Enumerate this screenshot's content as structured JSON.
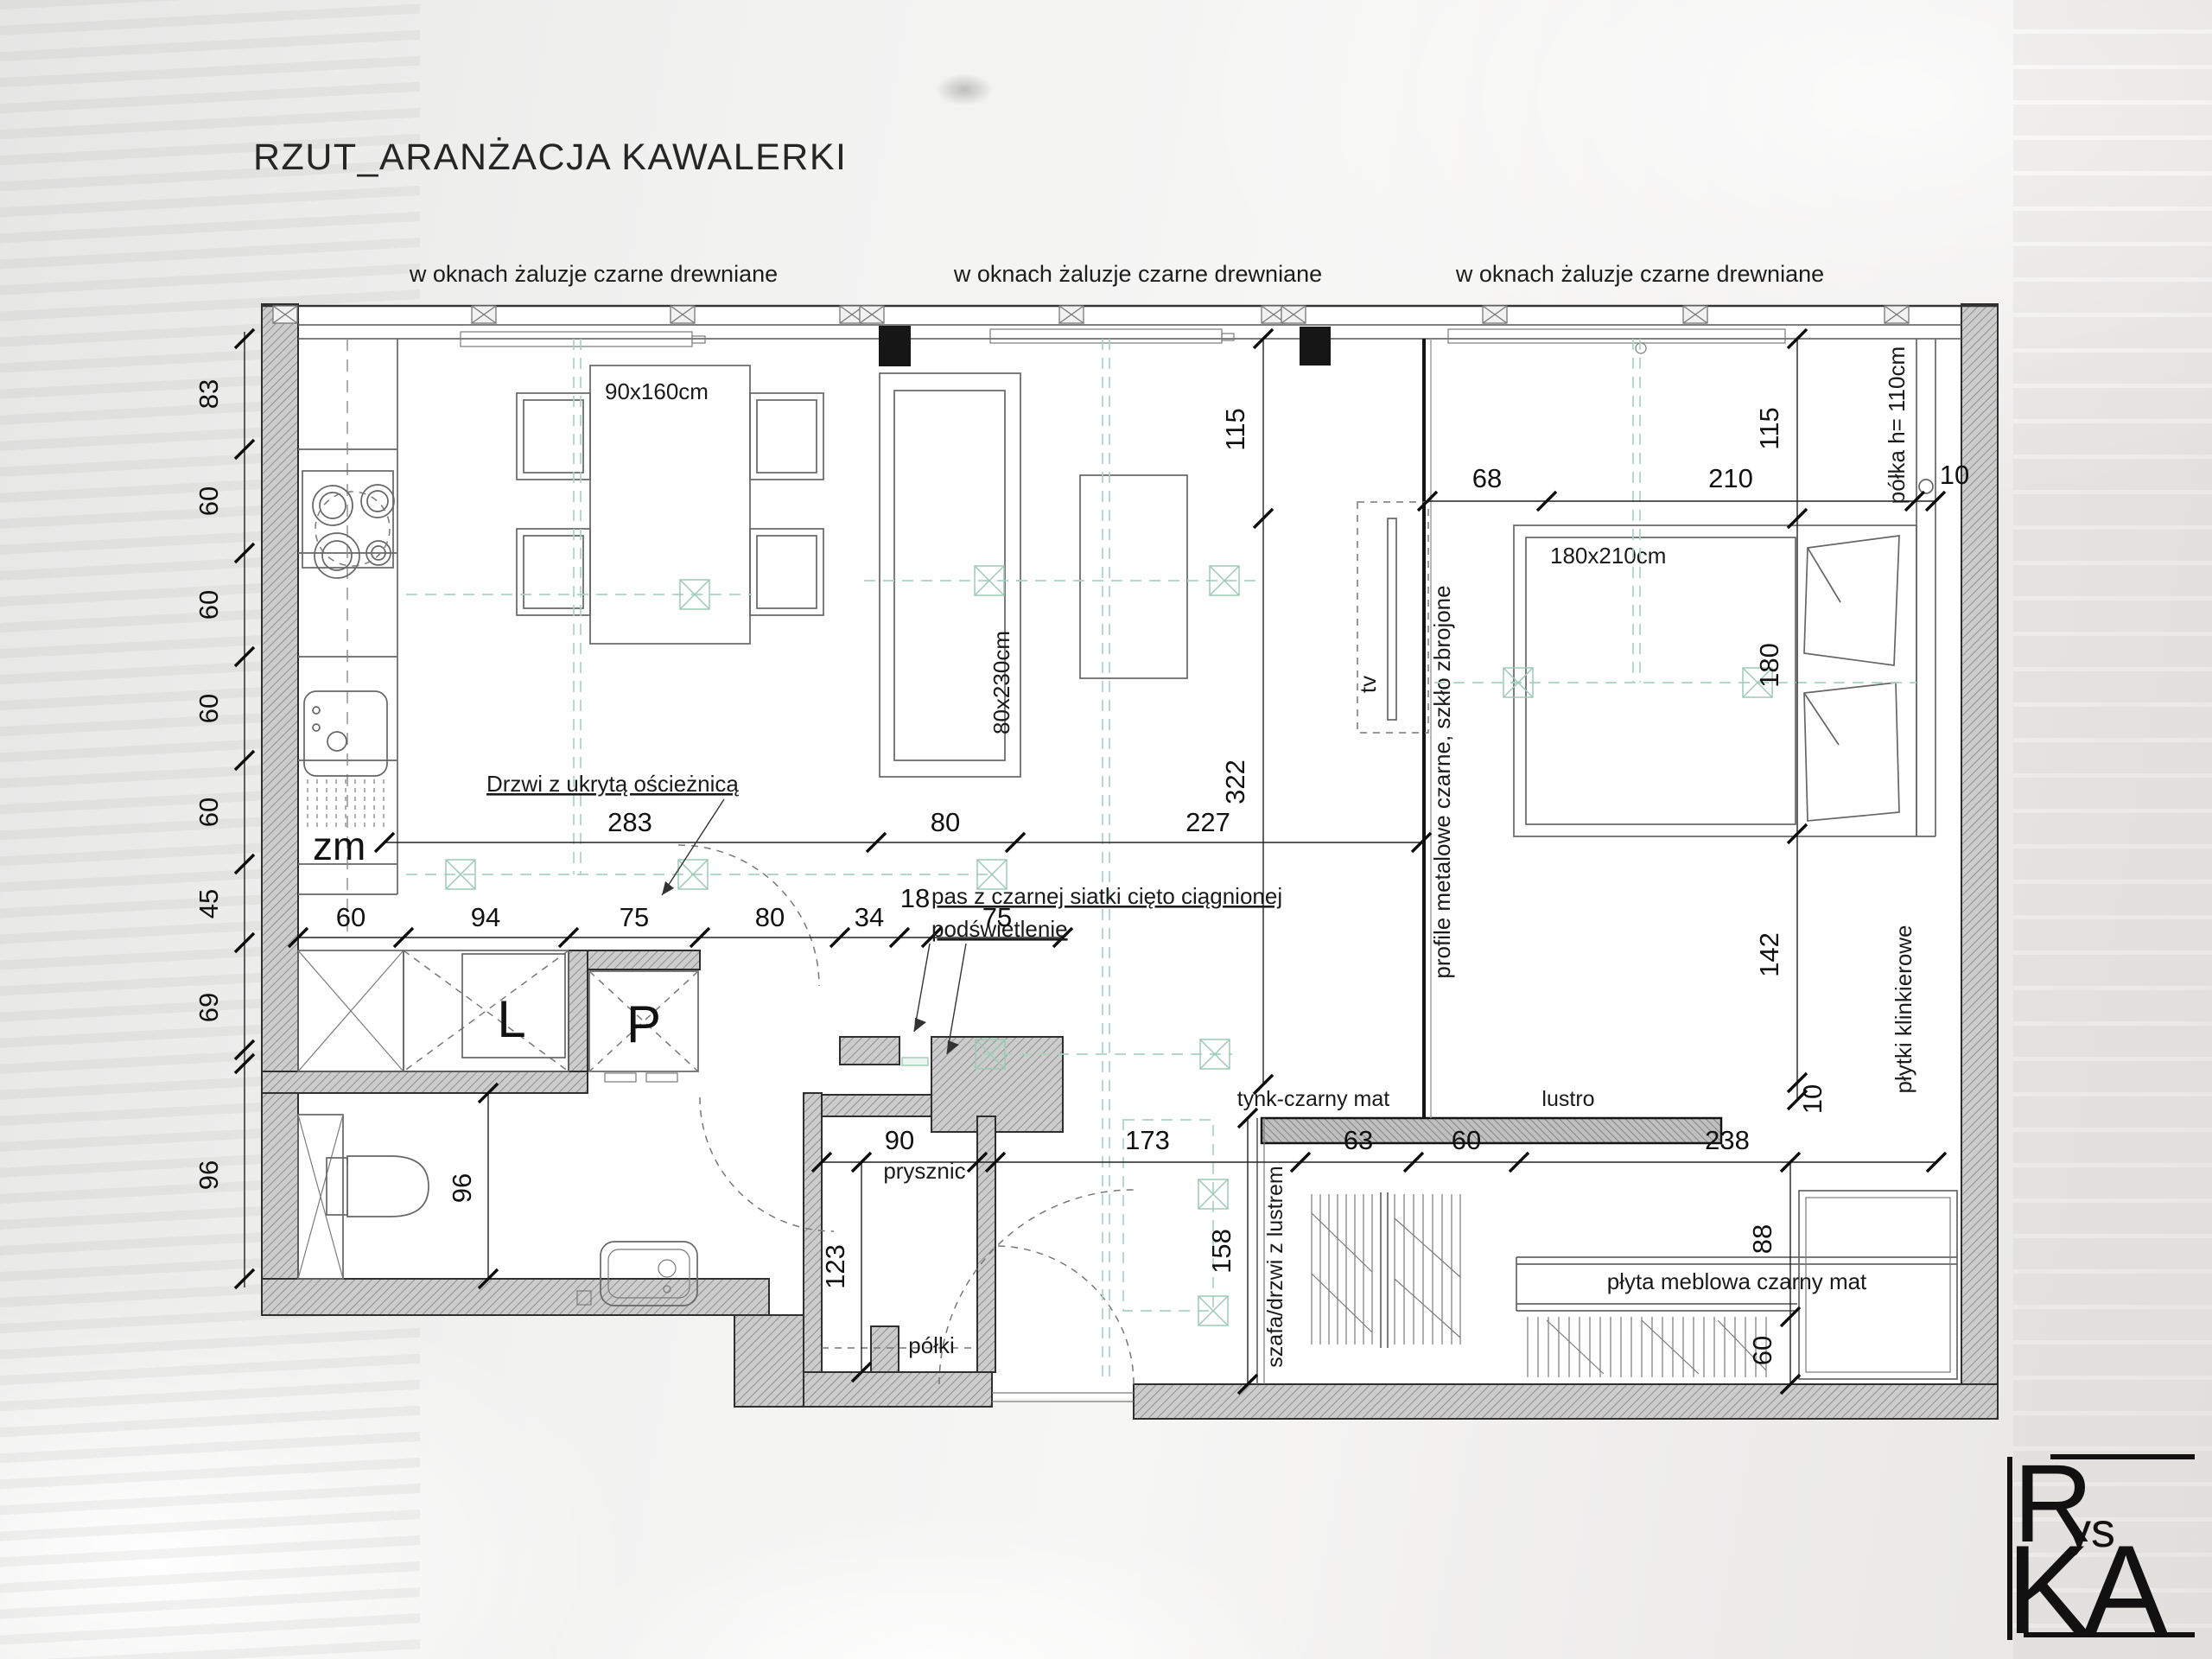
{
  "title": "RZUT_ARANŻACJA KAWALERKI",
  "window_notes": [
    "w oknach żaluzje czarne drewniane",
    "w oknach żaluzje czarne drewniane",
    "w oknach żaluzje czarne drewniane"
  ],
  "rooms": {
    "table_size": "90x160cm",
    "sofa_size": "80x230cm",
    "bed_size": "180x210cm",
    "sink_label": "zm",
    "cabinet_l": "L",
    "cabinet_p": "P",
    "tv": "tv",
    "shower": "prysznic",
    "shelves": "półki"
  },
  "notes": {
    "hidden_door": "Drzwi z ukrytą ościeżnicą",
    "mesh_line1": "pas z czarnej siatki cięto ciągnionej",
    "mesh_line2": "podświetlenie",
    "profiles": "profile metalowe czarne, szkło zbrojone",
    "shelf_height": "półka h= 110cm",
    "plaster": "tynk-czarny mat",
    "mirror": "lustro",
    "wardrobe": "szafa/drzwi z lustrem",
    "board": "płyta meblowa czarny mat",
    "clinker": "płytki klinkierowe"
  },
  "dims": {
    "left_chain": [
      "83",
      "60",
      "60",
      "60",
      "60",
      "45",
      "69",
      "96"
    ],
    "left_inner": [
      "115",
      "322"
    ],
    "mid_row": [
      "283",
      "80",
      "227"
    ],
    "cabinet_row": [
      "60",
      "94",
      "75",
      "80",
      "34",
      "18",
      "75"
    ],
    "bath": "96",
    "shower_w": "90",
    "shower_l": "123",
    "bottom_row": [
      "173",
      "63",
      "60",
      "238"
    ],
    "hall": "158",
    "desk": [
      "88",
      "60"
    ],
    "bed_top": [
      "68",
      "210"
    ],
    "shelf_gap": "10",
    "right_chain": [
      "115",
      "180",
      "142"
    ],
    "right_gap": "10"
  },
  "logo": {
    "r": "R",
    "ys": "ys",
    "ka": "KA"
  }
}
